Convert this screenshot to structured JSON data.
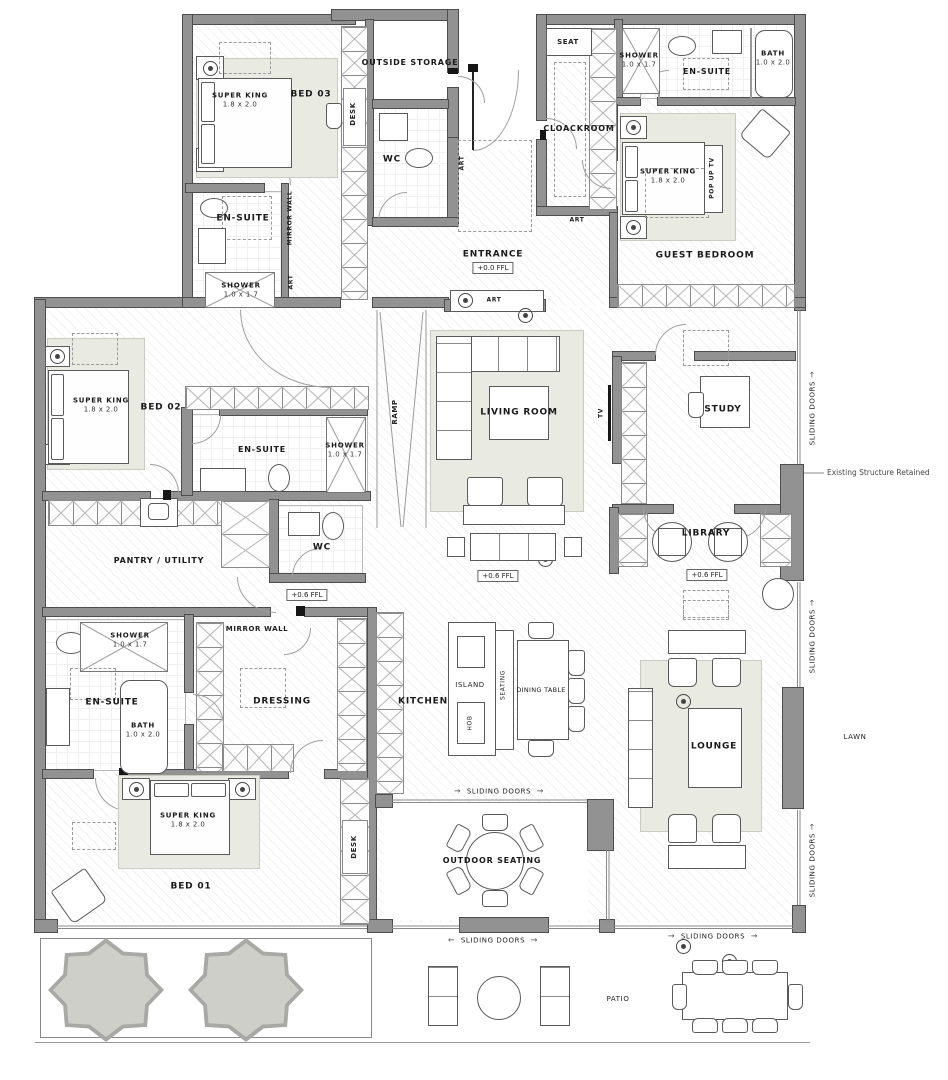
{
  "rooms": {
    "bed03": "BED 03",
    "outside_storage": "OUTSIDE STORAGE",
    "wc": "WC",
    "ensuite": "EN-SUITE",
    "cloackroom": "CLOACKROOM",
    "guest_bedroom": "GUEST BEDROOM",
    "entrance": "ENTRANCE",
    "bed02": "BED 02",
    "living_room": "LIVING ROOM",
    "study": "STUDY",
    "library": "LIBRARY",
    "pantry_utility": "PANTRY / UTILITY",
    "dressing": "DRESSING",
    "kitchen": "KITCHEN",
    "lounge": "LOUNGE",
    "bed01": "BED 01",
    "outdoor_seating": "OUTDOOR SEATING",
    "patio": "PATIO",
    "lawn": "LAWN"
  },
  "fixtures": {
    "super_king": {
      "name": "SUPER KING",
      "size": "1.8 x 2.0"
    },
    "shower": {
      "name": "SHOWER",
      "size": "1.0 x 1.7"
    },
    "bath": {
      "name": "BATH",
      "size": "1.0 x 2.0"
    },
    "island": "ISLAND",
    "hob": "HOB",
    "seating": "SEATING",
    "dining_table": "DINING TABLE",
    "seat": "SEAT",
    "desk": "DESK",
    "tv": "TV",
    "pop_up_tv": "POP UP TV",
    "ramp": "RAMP",
    "art": "ART",
    "mirror_wall": "MIRROR WALL"
  },
  "levels": {
    "entrance_ffl": "+0.0 FFL",
    "main_ffl": "+0.6 FFL"
  },
  "annotations": {
    "sliding_doors": "SLIDING DOORS",
    "existing_structure": "Existing Structure Retained"
  },
  "icons": {
    "arrow_right": "→",
    "arrow_left": "←"
  },
  "colors": {
    "wall": "#929292",
    "rug": "#e9ebe3",
    "tree": "#cfcfca"
  }
}
